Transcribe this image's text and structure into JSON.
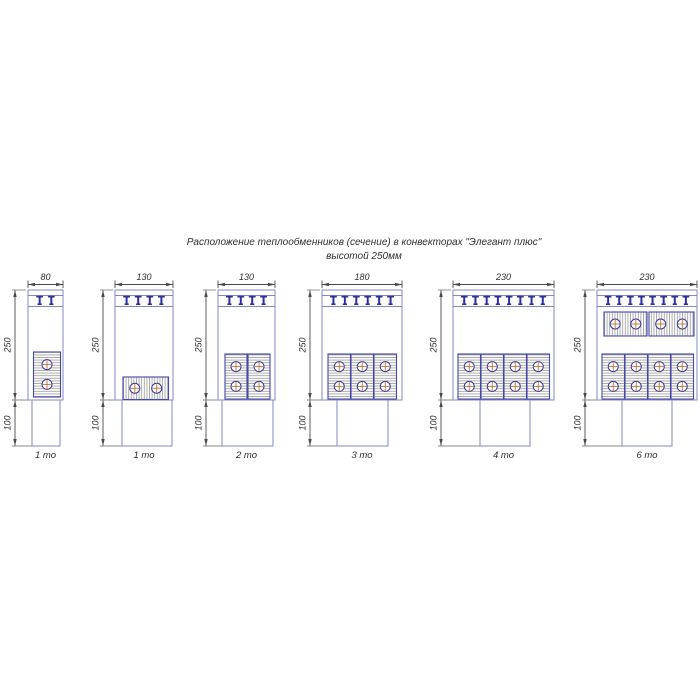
{
  "title": {
    "line1": "Расположение теплообменников (сечение) в конвекторах \"Элегант плюс\"",
    "line2": "высотой 250мм"
  },
  "dimensions": {
    "height_main_mm": "250",
    "height_base_mm": "100"
  },
  "colors": {
    "outline": "#8089c6",
    "bracket": "#2d2f9e",
    "block_border": "#4549a8",
    "block_fill": "#fcfcfc",
    "hatch_line": "#8e8e8e",
    "tube_outline": "#34378f",
    "tube_cross": "#c0703a",
    "dimension_line": "#4a4a4a",
    "extension_tick": "#8a8a8a",
    "text": "#2e2e2e"
  },
  "diagrams": [
    {
      "id": "variant-1to-80",
      "width_mm": "80",
      "label": "1 то",
      "exchanger_count": 1,
      "tee_count": 2,
      "box": {
        "x": 28,
        "w": 35
      },
      "pedestal": {
        "x": 32,
        "w": 28
      },
      "dim_x": 15,
      "blocks": [
        {
          "dir": "v",
          "x": 33.5,
          "y": 352,
          "w": 27,
          "h": 45
        }
      ]
    },
    {
      "id": "variant-1to-130",
      "width_mm": "130",
      "label": "1 то",
      "exchanger_count": 1,
      "tee_count": 4,
      "box": {
        "x": 115,
        "w": 58
      },
      "pedestal": {
        "x": 122,
        "w": 50
      },
      "dim_x": 103,
      "blocks": [
        {
          "dir": "h",
          "x": 123,
          "y": 377,
          "w": 45.5,
          "h": 22.5
        }
      ]
    },
    {
      "id": "variant-2to-130",
      "width_mm": "130",
      "label": "2 то",
      "exchanger_count": 2,
      "tee_count": 4,
      "box": {
        "x": 218,
        "w": 57
      },
      "pedestal": {
        "x": 222,
        "w": 51
      },
      "dim_x": 206,
      "blocks": [
        {
          "dir": "v",
          "x": 225,
          "y": 354,
          "w": 22,
          "h": 45
        },
        {
          "dir": "v",
          "x": 248,
          "y": 354,
          "w": 22,
          "h": 45
        }
      ]
    },
    {
      "id": "variant-3to-180",
      "width_mm": "180",
      "label": "3 то",
      "exchanger_count": 3,
      "tee_count": 6,
      "box": {
        "x": 322,
        "w": 80
      },
      "pedestal": {
        "x": 337,
        "w": 51
      },
      "dim_x": 310,
      "blocks": [
        {
          "dir": "v",
          "x": 328,
          "y": 354,
          "w": 22.5,
          "h": 45
        },
        {
          "dir": "v",
          "x": 351,
          "y": 354,
          "w": 22.5,
          "h": 45
        },
        {
          "dir": "v",
          "x": 374,
          "y": 354,
          "w": 22.5,
          "h": 45
        }
      ]
    },
    {
      "id": "variant-4to-230",
      "width_mm": "230",
      "label": "4 то",
      "exchanger_count": 4,
      "tee_count": 8,
      "box": {
        "x": 453,
        "w": 101
      },
      "pedestal": {
        "x": 480,
        "w": 50
      },
      "dim_x": 441,
      "blocks": [
        {
          "dir": "v",
          "x": 458,
          "y": 354,
          "w": 22.5,
          "h": 45
        },
        {
          "dir": "v",
          "x": 481,
          "y": 354,
          "w": 22.5,
          "h": 45
        },
        {
          "dir": "v",
          "x": 504,
          "y": 354,
          "w": 22.5,
          "h": 45
        },
        {
          "dir": "v",
          "x": 527,
          "y": 354,
          "w": 22.5,
          "h": 45
        }
      ]
    },
    {
      "id": "variant-6to-230",
      "width_mm": "230",
      "label": "6 то",
      "exchanger_count": 6,
      "tee_count": 8,
      "box": {
        "x": 597,
        "w": 100
      },
      "pedestal": {
        "x": 622,
        "w": 50
      },
      "dim_x": 585,
      "blocks": [
        {
          "dir": "h",
          "x": 604,
          "y": 312,
          "w": 43,
          "h": 24
        },
        {
          "dir": "h",
          "x": 649,
          "y": 312,
          "w": 45,
          "h": 24
        },
        {
          "dir": "v",
          "x": 602,
          "y": 354,
          "w": 22.5,
          "h": 45
        },
        {
          "dir": "v",
          "x": 625,
          "y": 354,
          "w": 22.5,
          "h": 45
        },
        {
          "dir": "v",
          "x": 648,
          "y": 354,
          "w": 22.5,
          "h": 45
        },
        {
          "dir": "v",
          "x": 671,
          "y": 354,
          "w": 22.5,
          "h": 45
        }
      ]
    }
  ]
}
